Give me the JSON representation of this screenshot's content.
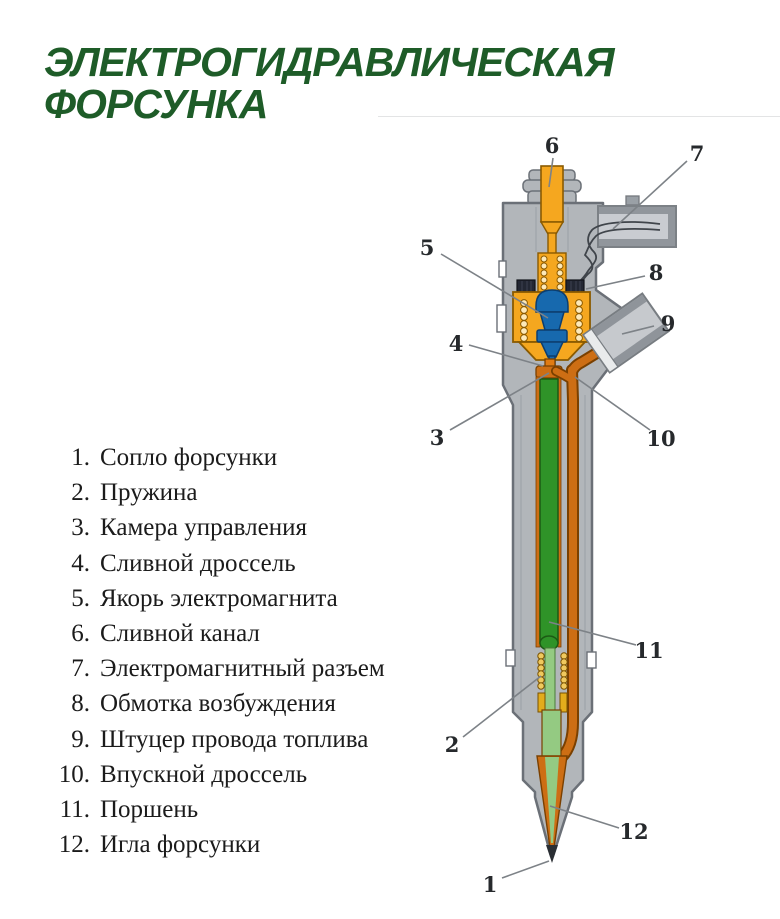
{
  "title": {
    "line1": "ЭЛЕКТРОГИДРАВЛИЧЕСКАЯ",
    "line2": "ФОРСУНКА"
  },
  "legend": {
    "items": [
      {
        "num": "1.",
        "label": "Сопло форсунки"
      },
      {
        "num": "2.",
        "label": "Пружина"
      },
      {
        "num": "3.",
        "label": "Камера управления"
      },
      {
        "num": "4.",
        "label": "Сливной дроссель"
      },
      {
        "num": "5.",
        "label": "Якорь электромагнита"
      },
      {
        "num": "6.",
        "label": "Сливной канал"
      },
      {
        "num": "7.",
        "label": "Электромагнитный разъем"
      },
      {
        "num": "8.",
        "label": "Обмотка возбуждения"
      },
      {
        "num": "9.",
        "label": "Штуцер провода топлива"
      },
      {
        "num": "10.",
        "label": "Впускной дроссель"
      },
      {
        "num": "11.",
        "label": "Поршень"
      },
      {
        "num": "12.",
        "label": "Игла форсунки"
      }
    ]
  },
  "diagram": {
    "callouts": {
      "c1": "1",
      "c2": "2",
      "c3": "3",
      "c4": "4",
      "c5": "5",
      "c6": "6",
      "c7": "7",
      "c8": "8",
      "c9": "9",
      "c10": "10",
      "c11": "11",
      "c12": "12"
    }
  },
  "colors": {
    "title_green": "#1e5c28",
    "body_gray": "#b2b6ba",
    "body_outline": "#6b7077",
    "channel_orange": "#f5a71f",
    "fuel_line_orange": "#cd6e14",
    "fuel_line_edge": "#7a4000",
    "piston_green": "#2f9328",
    "needle_green": "#94ca82",
    "armature_blue": "#1769ae",
    "spring_gold": "#e3ac1c",
    "coil_dark": "#232733",
    "callout_color": "#26292c",
    "leader_gray": "#7d8287"
  }
}
